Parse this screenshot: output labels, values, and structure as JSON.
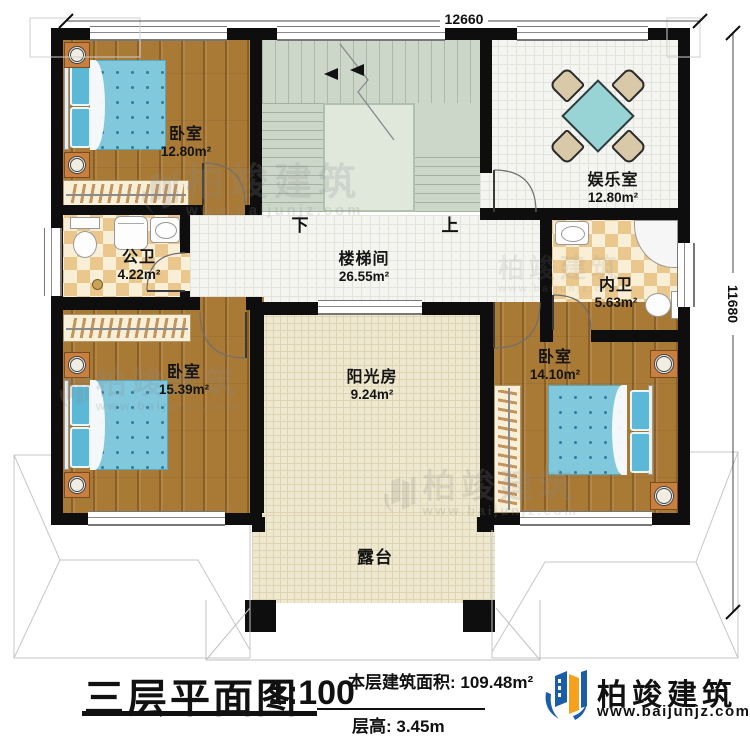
{
  "plan": {
    "dim_top": "12660",
    "dim_right": "11680",
    "rooms": {
      "bedroom1": {
        "name": "卧室",
        "area": "12.80m²"
      },
      "entertainment": {
        "name": "娱乐室",
        "area": "12.80m²"
      },
      "public_bath": {
        "name": "公卫",
        "area": "4.22m²"
      },
      "stair_hall": {
        "name": "楼梯间",
        "area": "26.55m²"
      },
      "private_bath": {
        "name": "内卫",
        "area": "5.63m²"
      },
      "bedroom2": {
        "name": "卧室",
        "area": "15.39m²"
      },
      "sunroom": {
        "name": "阳光房",
        "area": "9.24m²"
      },
      "bedroom3": {
        "name": "卧室",
        "area": "14.10m²"
      },
      "terrace": {
        "name": "露台"
      }
    },
    "stairs": {
      "down": "下",
      "up": "上"
    }
  },
  "title_block": {
    "title": "三层平面图",
    "scale": "1:100",
    "floor_area": "本层建筑面积: 109.48m²",
    "floor_height": "层高: 3.45m"
  },
  "brand": {
    "name": "柏竣建筑",
    "website": "www.baijunjz.com"
  },
  "watermark": {
    "name": "柏竣建筑",
    "website": "www.baijunjz.com"
  },
  "colors": {
    "wall": "#0e0e0e",
    "wood_floor": "#a97a36",
    "bed_blue": "#82c8dd",
    "stair_green": "#ccd7c9",
    "checker_tan": "#e9c78d",
    "brand_blue": "#1b5ea8",
    "brand_orange": "#f5a11c"
  }
}
